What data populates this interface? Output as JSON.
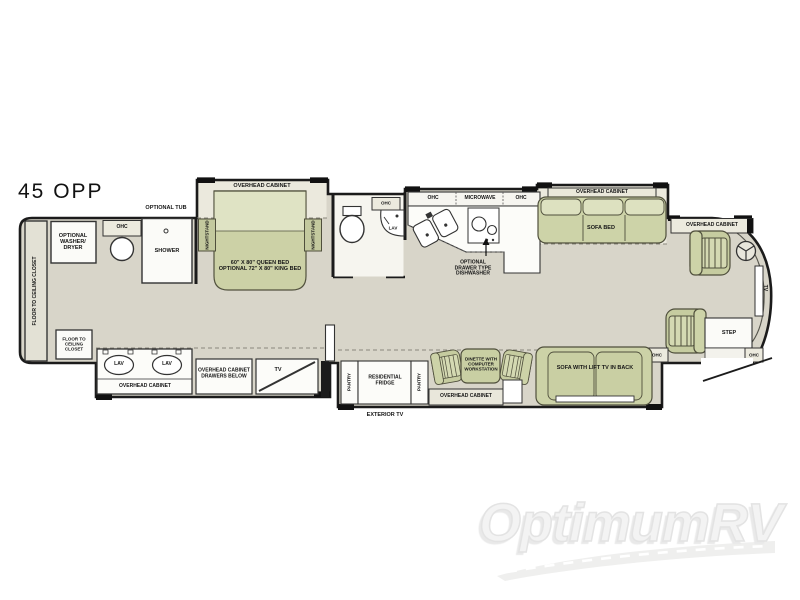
{
  "page": {
    "title": "45 OPP"
  },
  "watermark": {
    "brand": "OptimumRV"
  },
  "colors": {
    "wall": "#1b1b1b",
    "floor": "#d8d5c9",
    "slide_floor": "#ebe9dd",
    "furniture_green": "#ccd1a6",
    "furniture_light": "#dfe3c4",
    "fixture_white": "#fbfbf8"
  },
  "floorplan": {
    "rear_bath": {
      "closet_side": "FLOOR TO CEILING CLOSET",
      "washer_dryer": "OPTIONAL\nWASHER/\nDRYER",
      "ohc": "OHC",
      "shower": "SHOWER",
      "optional_tub": "OPTIONAL TUB"
    },
    "bedroom": {
      "overhead_cabinet": "OVERHEAD CABINET",
      "nightstand": "NIGHTSTAND",
      "bed": "60\" X 80\" QUEEN BED\nOPTIONAL 72\" X 80\" KING BED",
      "closet": "FLOOR TO\nCEILING\nCLOSET",
      "lav": "LAV",
      "vanity_cabinet": "OVERHEAD CABINET",
      "drawers": "OVERHEAD CABINET\nDRAWERS BELOW",
      "tv": "TV"
    },
    "mid_bath": {
      "ohc": "OHC",
      "lav": "LAV"
    },
    "kitchen": {
      "ohc": "OHC",
      "microwave": "MICROWAVE",
      "dishwasher": "OPTIONAL\nDRAWER TYPE\nDISHWASHER",
      "pantry": "PANTRY",
      "fridge": "RESIDENTIAL\nFRIDGE",
      "exterior_tv": "EXTERIOR TV"
    },
    "living": {
      "overhead_cabinet": "OVERHEAD CABINET",
      "sofa_bed": "SOFA BED",
      "dinette": "DINETTE WITH\nCOMPUTER\nWORKSTATION",
      "dinette_cabinet": "OVERHEAD CABINET",
      "sofa_lift_tv": "SOFA WITH LIFT TV IN BACK"
    },
    "cockpit": {
      "overhead_cabinet": "OVERHEAD CABINET",
      "tv": "TV",
      "step": "STEP",
      "ohc": "OHC"
    }
  }
}
